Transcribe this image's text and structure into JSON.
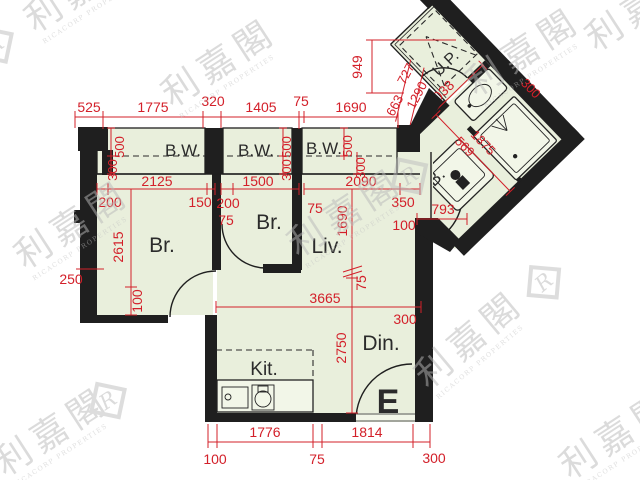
{
  "colors": {
    "wall": "#1f1f1f",
    "floor": "#e9efdc",
    "dimension_red": "#d3202a",
    "fixture_fill": "#f2f6e8",
    "watermark_gray": "#bdbdbd"
  },
  "rooms": {
    "bay_window": "B.W.",
    "bedroom": "Br.",
    "living_room": "Liv.",
    "dining_room": "Din.",
    "kitchen": "Kit.",
    "bathroom": "B.",
    "utility_platform": "U.P.",
    "entrance_marker": "E"
  },
  "dims": {
    "top": [
      "525",
      "1775",
      "320",
      "1405",
      "75",
      "1690"
    ],
    "side_height": "949",
    "bw_depth": "500",
    "bw_inner": "300",
    "br1_width": "2125",
    "br1_left": "200",
    "br1_right": "150",
    "br1_height": "2615",
    "br1_door": "100",
    "left_offset": "250",
    "br2_width": "1500",
    "br2_left": "200",
    "br2_wall": "75",
    "pier": "75",
    "liv_width": "2090",
    "liv_upper": "350",
    "liv_upper2": "100",
    "liv_height": "1690",
    "liv_wall": "75",
    "liv_span": "3665",
    "right_wall": "300",
    "din_height": "2750",
    "bottom_kit": "1776",
    "bottom_din": "1814",
    "bottom_left": "100",
    "bottom_mid": "75",
    "bottom_right": "300",
    "wing_edge_a": "663",
    "wing_edge_b": "727",
    "wing_edge_c": "1290",
    "wing_width": "2038",
    "wing_bath_a": "569",
    "wing_bath_b": "1875",
    "wing_edge_d": "326",
    "wing_wall": "300",
    "wing_lobby": "350",
    "wing_door": "793",
    "wing_off": "100"
  },
  "watermark": {
    "cn": "利嘉閣",
    "en": "RICACORP PROPERTIES",
    "logo": "R"
  }
}
